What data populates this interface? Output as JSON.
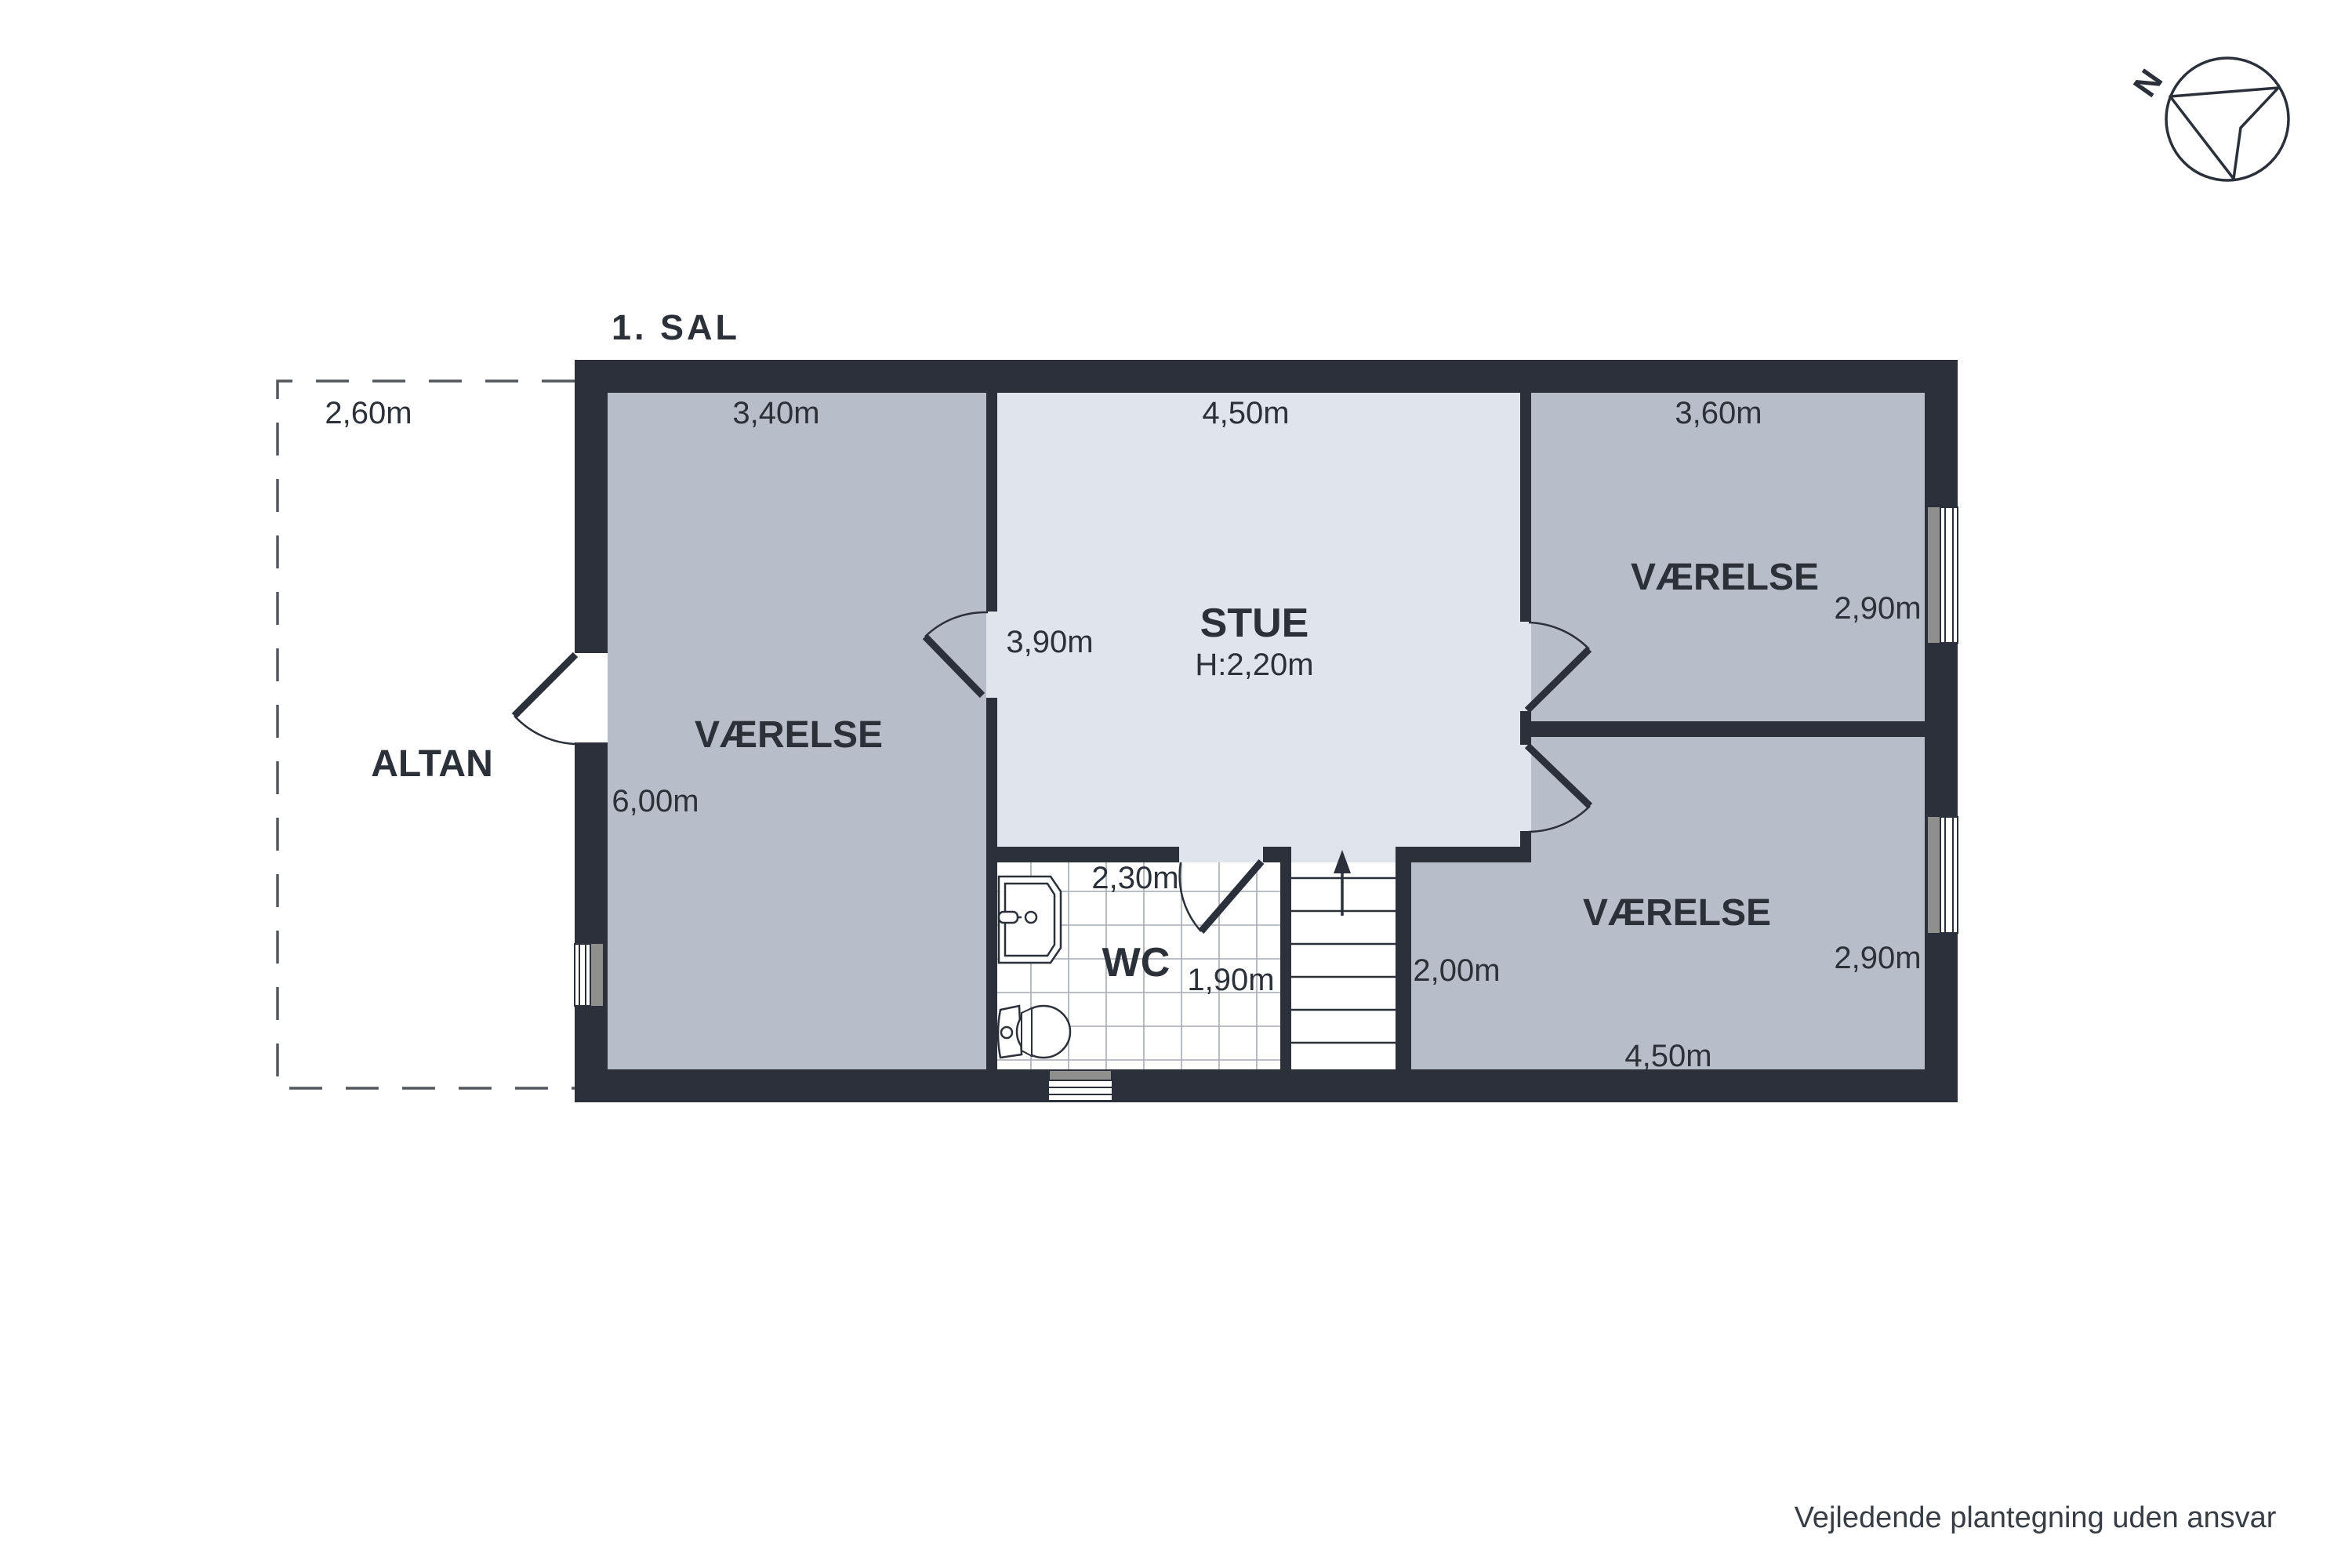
{
  "floor_plan": {
    "title": "1. SAL",
    "altan": {
      "label": "ALTAN",
      "width": "2,60m"
    },
    "room_left": {
      "label": "VÆRELSE",
      "width": "3,40m",
      "height": "6,00m"
    },
    "stue": {
      "label": "STUE",
      "ceiling_height": "H:2,20m",
      "width": "4,50m",
      "door_side": "3,90m"
    },
    "room_top_right": {
      "label": "VÆRELSE",
      "width": "3,60m",
      "height": "2,90m"
    },
    "room_bottom_right": {
      "label": "VÆRELSE",
      "height": "2,90m",
      "width": "4,50m",
      "stairs_side": "2,00m"
    },
    "wc": {
      "label": "WC",
      "width": "2,30m",
      "height": "1,90m"
    },
    "compass": {
      "letter": "N"
    },
    "disclaimer": "Vejledende plantegning uden ansvar"
  },
  "colors": {
    "background": "#ffffff",
    "wall": "#2b303b",
    "room": "#b8bec9",
    "stue": "#dfe4ed",
    "wc_floor": "#ffffff",
    "tile_line": "#a6abb4",
    "window_jamb": "#8f8f8d",
    "dash": "#53575f",
    "text": "#2b3039"
  }
}
